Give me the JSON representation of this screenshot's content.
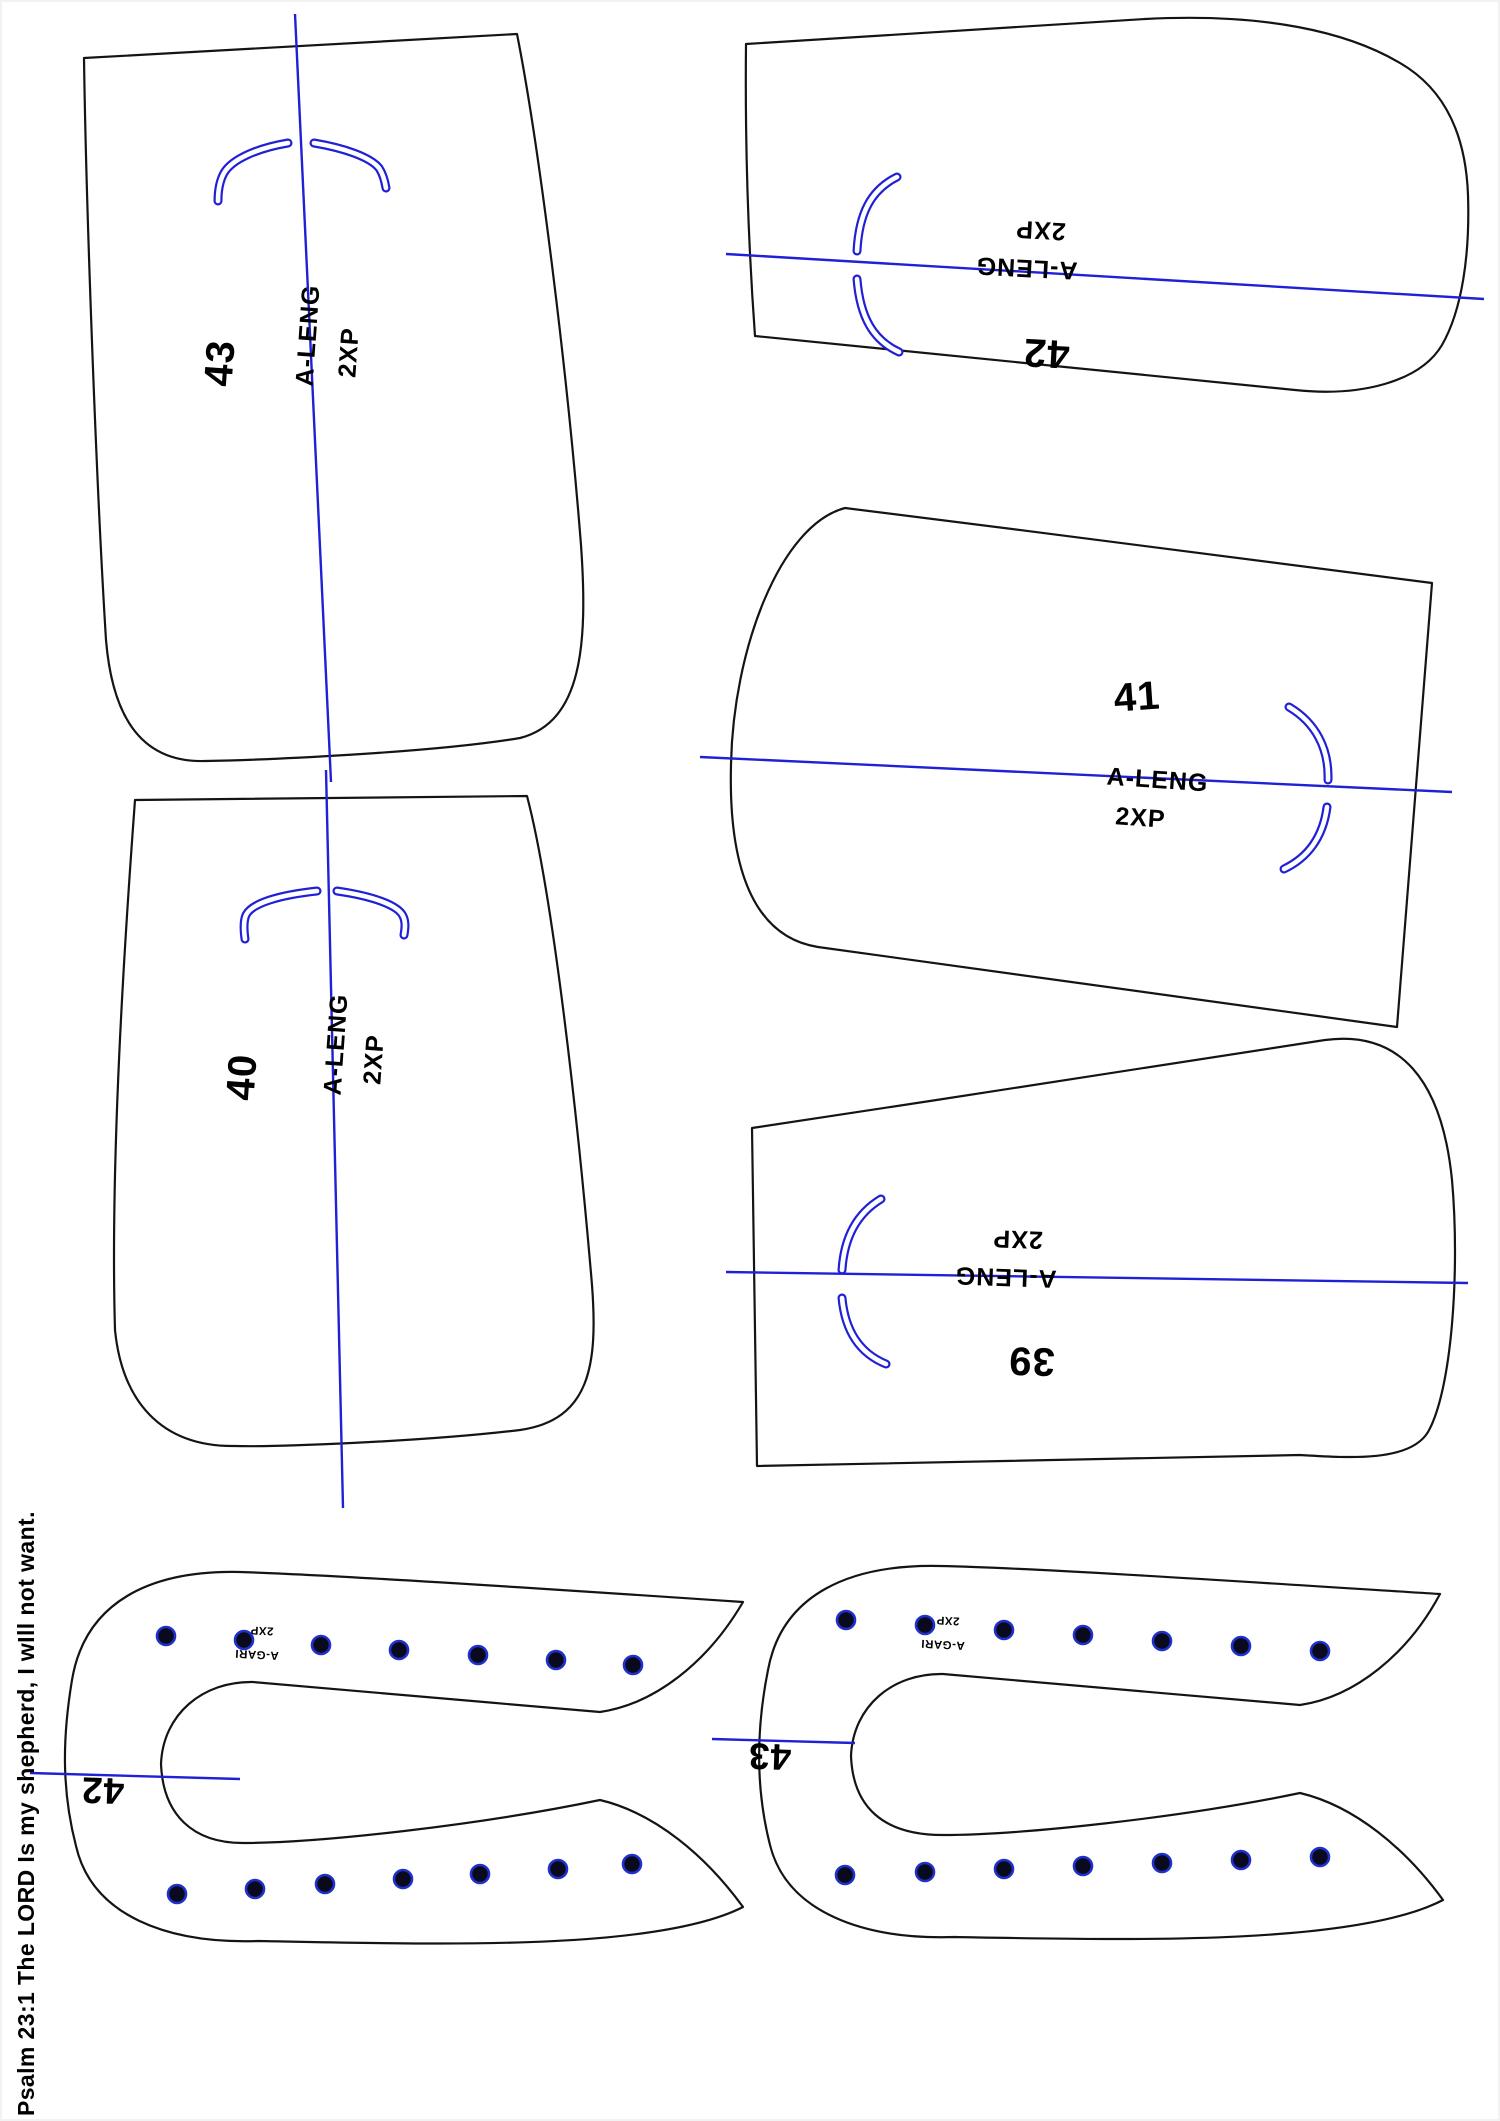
{
  "sheet": {
    "type": "sewing-pattern-sheet",
    "footer_text": "Psalm 23:1 The LORD Is my shepherd, I wIll not want."
  },
  "colors": {
    "background": "#ffffff",
    "outline_black": "#141414",
    "guide_blue": "#2020d6",
    "dot_fill": "#0a0a1e",
    "dot_ring": "#2030cc",
    "text": "#000000"
  },
  "pieces": {
    "p43": {
      "number": "43",
      "grain_label": "A-LENG",
      "size_label": "2XP"
    },
    "p42": {
      "number": "42",
      "grain_label": "A-LENG",
      "size_label": "2XP"
    },
    "p41": {
      "number": "41",
      "grain_label": "A-LENG",
      "size_label": "2XP"
    },
    "p40": {
      "number": "40",
      "grain_label": "A-LENG",
      "size_label": "2XP"
    },
    "p39": {
      "number": "39",
      "grain_label": "A-LENG",
      "size_label": "2XP"
    },
    "band42": {
      "number": "42",
      "grain_label": "A-GARI",
      "size_label": "2XP",
      "snap_dots_top": 7,
      "snap_dots_bottom": 7
    },
    "band43": {
      "number": "43",
      "grain_label": "A-GARI",
      "size_label": "2XP",
      "snap_dots_top": 7,
      "snap_dots_bottom": 7
    }
  }
}
